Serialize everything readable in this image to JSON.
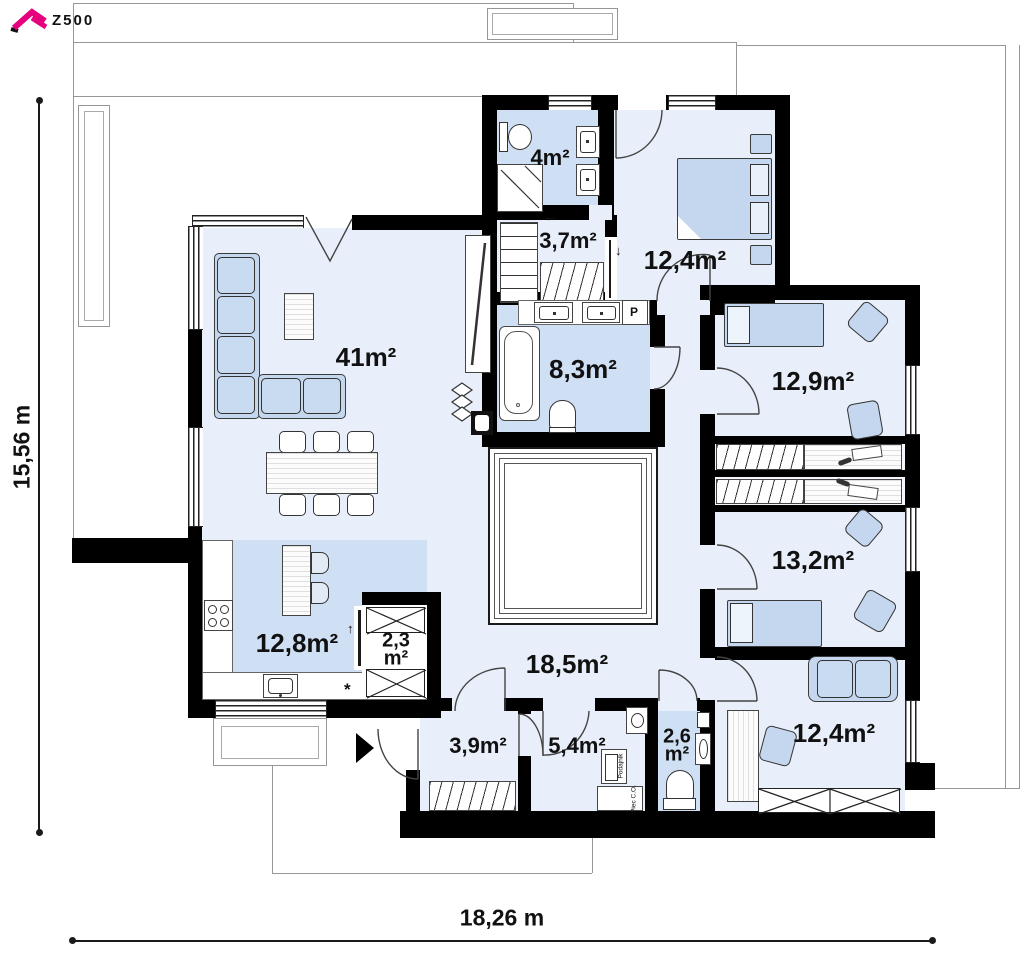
{
  "logo": {
    "text": "Z500",
    "accent_color": "#e6007e"
  },
  "dimensions": {
    "height_label": "15,56 m",
    "width_label": "18,26 m"
  },
  "rooms": {
    "bath_small": "4m²",
    "closet": "3,7m²",
    "bedroom_top": "12,4m²",
    "living": "41m²",
    "bathroom": "8,3m²",
    "bedroom_right1": "12,9m²",
    "bedroom_right2": "13,2m²",
    "kitchen": "12,8m²",
    "pantry_line1": "2,3",
    "pantry_line2": "m²",
    "hall": "18,5m²",
    "vestibule": "3,9m²",
    "boiler": "5,4m²",
    "wc_line1": "2,6",
    "wc_line2": "m²",
    "office": "12,4m²"
  },
  "annotations": {
    "washing_machine": "P",
    "appliance_star": "*",
    "feeder": "Podajnik",
    "furnace": "Piec C.O.",
    "arrow_left": "←",
    "arrow_down": "↓",
    "arrow_up": "↑"
  },
  "colors": {
    "wall": "#000000",
    "room_light": "#e9effa",
    "room_highlight": "#cfe0f4",
    "furniture_blue": "#c4d7ee",
    "accent_pink": "#e6007e"
  }
}
